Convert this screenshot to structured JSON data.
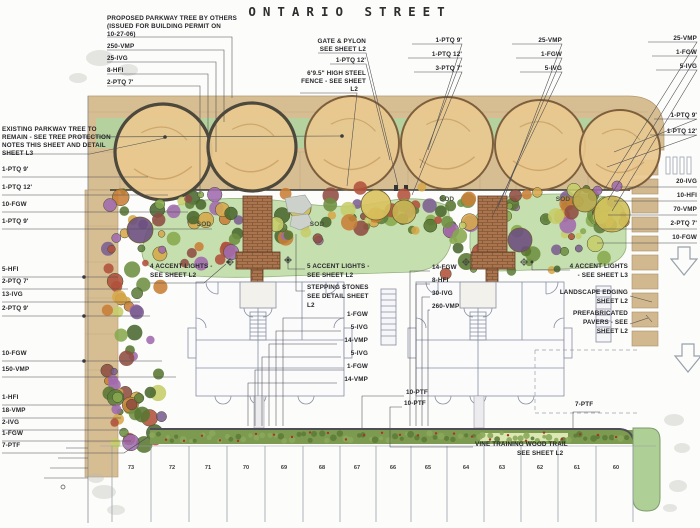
{
  "title": "ONTARIO STREET",
  "colors": {
    "sidewalk_tan": "#d7bd92",
    "parkway_lawn": "#b4d19e",
    "sod_lawn": "#c6dfae",
    "tree_canopy": "#e9c88f",
    "brick_walk": "#a9744e",
    "hedge_green": "#79994e",
    "building_line": "#868ea0",
    "leader_line": "#4b4b50"
  },
  "annotations": [
    {
      "t": "PROPOSED PARKWAY TREE BY OTHERS",
      "x": 107,
      "y": 15,
      "a": "L"
    },
    {
      "t": "(ISSUED FOR BUILDING PERMIT ON",
      "x": 107,
      "y": 23,
      "a": "L"
    },
    {
      "t": "10-27-06)",
      "x": 107,
      "y": 31,
      "a": "L"
    },
    {
      "t": "250-VMP",
      "x": 107,
      "y": 43,
      "a": "L"
    },
    {
      "t": "25-IVG",
      "x": 107,
      "y": 55,
      "a": "L"
    },
    {
      "t": "8-HFI",
      "x": 107,
      "y": 67,
      "a": "L"
    },
    {
      "t": "2-PTQ 7'",
      "x": 107,
      "y": 79,
      "a": "L"
    },
    {
      "t": "GATE & PYLON",
      "x": 366,
      "y": 38,
      "a": "R"
    },
    {
      "t": "SEE SHEET L2",
      "x": 366,
      "y": 46,
      "a": "R"
    },
    {
      "t": "1-PTQ 12'",
      "x": 366,
      "y": 57,
      "a": "R"
    },
    {
      "t": "6'9.5\" HIGH STEEL",
      "x": 366,
      "y": 70,
      "a": "R"
    },
    {
      "t": "FENCE - SEE SHEET",
      "x": 366,
      "y": 78,
      "a": "R"
    },
    {
      "t": "L2",
      "x": 358,
      "y": 86,
      "a": "R"
    },
    {
      "t": "1-PTQ 9'",
      "x": 462,
      "y": 37,
      "a": "R"
    },
    {
      "t": "1-PTQ 12'",
      "x": 462,
      "y": 51,
      "a": "R"
    },
    {
      "t": "3-PTQ 7'",
      "x": 462,
      "y": 65,
      "a": "R"
    },
    {
      "t": "25-VMP",
      "x": 562,
      "y": 37,
      "a": "R"
    },
    {
      "t": "1-FGW",
      "x": 562,
      "y": 51,
      "a": "R"
    },
    {
      "t": "5-IVG",
      "x": 562,
      "y": 65,
      "a": "R"
    },
    {
      "t": "25-VMP",
      "x": 697,
      "y": 35,
      "a": "R"
    },
    {
      "t": "1-FGW",
      "x": 697,
      "y": 49,
      "a": "R"
    },
    {
      "t": "5-IVG",
      "x": 697,
      "y": 63,
      "a": "R"
    },
    {
      "t": "1-PTQ 9'",
      "x": 697,
      "y": 112,
      "a": "R"
    },
    {
      "t": "1-PTQ 12'",
      "x": 697,
      "y": 128,
      "a": "R"
    },
    {
      "t": "20-IVG",
      "x": 697,
      "y": 178,
      "a": "R"
    },
    {
      "t": "10-HFI",
      "x": 697,
      "y": 192,
      "a": "R"
    },
    {
      "t": "70-VMP",
      "x": 697,
      "y": 206,
      "a": "R"
    },
    {
      "t": "2-PTQ 7'",
      "x": 697,
      "y": 220,
      "a": "R"
    },
    {
      "t": "10-FGW",
      "x": 697,
      "y": 234,
      "a": "R"
    },
    {
      "t": "EXISTING PARKWAY TREE TO",
      "x": 2,
      "y": 126,
      "a": "L"
    },
    {
      "t": "REMAIN - SEE TREE PROTECTION",
      "x": 2,
      "y": 134,
      "a": "L"
    },
    {
      "t": "NOTES THIS SHEET AND DETAIL",
      "x": 2,
      "y": 142,
      "a": "L"
    },
    {
      "t": "SHEET L3",
      "x": 2,
      "y": 150,
      "a": "L"
    },
    {
      "t": "1-PTQ 9'",
      "x": 2,
      "y": 166,
      "a": "L"
    },
    {
      "t": "1-PTQ 12'",
      "x": 2,
      "y": 184,
      "a": "L"
    },
    {
      "t": "10-FGW",
      "x": 2,
      "y": 201,
      "a": "L"
    },
    {
      "t": "1-PTQ 9'",
      "x": 2,
      "y": 218,
      "a": "L"
    },
    {
      "t": "5-HFI",
      "x": 2,
      "y": 266,
      "a": "L"
    },
    {
      "t": "2-PTQ 7'",
      "x": 2,
      "y": 278,
      "a": "L"
    },
    {
      "t": "13-IVG",
      "x": 2,
      "y": 291,
      "a": "L"
    },
    {
      "t": "2-PTQ 9'",
      "x": 2,
      "y": 305,
      "a": "L"
    },
    {
      "t": "10-FGW",
      "x": 2,
      "y": 350,
      "a": "L"
    },
    {
      "t": "150-VMP",
      "x": 2,
      "y": 366,
      "a": "L"
    },
    {
      "t": "1-HFI",
      "x": 2,
      "y": 394,
      "a": "L"
    },
    {
      "t": "18-VMP",
      "x": 2,
      "y": 407,
      "a": "L"
    },
    {
      "t": "2-IVG",
      "x": 2,
      "y": 419,
      "a": "L"
    },
    {
      "t": "1-FGW",
      "x": 2,
      "y": 430,
      "a": "L"
    },
    {
      "t": "7-PTF",
      "x": 2,
      "y": 442,
      "a": "L"
    },
    {
      "t": "4 ACCENT LIGHTS -",
      "x": 150,
      "y": 263,
      "a": "L"
    },
    {
      "t": "SEE SHEET L2",
      "x": 150,
      "y": 272,
      "a": "L"
    },
    {
      "t": "5 ACCENT LIGHTS -",
      "x": 307,
      "y": 263,
      "a": "L"
    },
    {
      "t": "SEE SHEET L2",
      "x": 307,
      "y": 272,
      "a": "L"
    },
    {
      "t": "STEPPING STONES",
      "x": 307,
      "y": 284,
      "a": "L"
    },
    {
      "t": "SEE DETAIL SHEET",
      "x": 307,
      "y": 293,
      "a": "L"
    },
    {
      "t": "L2",
      "x": 307,
      "y": 302,
      "a": "L"
    },
    {
      "t": "1-FGW",
      "x": 368,
      "y": 311,
      "a": "R"
    },
    {
      "t": "5-IVG",
      "x": 368,
      "y": 324,
      "a": "R"
    },
    {
      "t": "14-VMP",
      "x": 368,
      "y": 337,
      "a": "R"
    },
    {
      "t": "5-IVG",
      "x": 368,
      "y": 350,
      "a": "R"
    },
    {
      "t": "1-FGW",
      "x": 368,
      "y": 363,
      "a": "R"
    },
    {
      "t": "14-VMP",
      "x": 368,
      "y": 376,
      "a": "R"
    },
    {
      "t": "14-FGW",
      "x": 432,
      "y": 264,
      "a": "L"
    },
    {
      "t": "8-HFI",
      "x": 432,
      "y": 277,
      "a": "L"
    },
    {
      "t": "30-IVG",
      "x": 432,
      "y": 290,
      "a": "L"
    },
    {
      "t": "260-VMP",
      "x": 432,
      "y": 303,
      "a": "L"
    },
    {
      "t": "4 ACCENT LIGHTS",
      "x": 628,
      "y": 263,
      "a": "R"
    },
    {
      "t": "- SEE SHEET L3",
      "x": 628,
      "y": 272,
      "a": "R"
    },
    {
      "t": "LANDSCAPE EDGING",
      "x": 628,
      "y": 289,
      "a": "R"
    },
    {
      "t": "SHEET L2",
      "x": 628,
      "y": 298,
      "a": "R"
    },
    {
      "t": "PREFABRICATED",
      "x": 628,
      "y": 310,
      "a": "R"
    },
    {
      "t": "PAVERS - SEE",
      "x": 628,
      "y": 319,
      "a": "R"
    },
    {
      "t": "SHEET L2",
      "x": 628,
      "y": 328,
      "a": "R"
    },
    {
      "t": "10-PTF",
      "x": 406,
      "y": 389,
      "a": "L"
    },
    {
      "t": "10-PTF",
      "x": 404,
      "y": 400,
      "a": "L"
    },
    {
      "t": "7-PTF",
      "x": 575,
      "y": 401,
      "a": "L"
    },
    {
      "t": "VINE TRAINING WOOD TRAIL",
      "x": 475,
      "y": 441,
      "a": "L"
    },
    {
      "t": "SEE SHEET L2",
      "x": 517,
      "y": 450,
      "a": "L"
    },
    {
      "t": "SOD",
      "x": 204,
      "y": 221,
      "a": "C"
    },
    {
      "t": "SOD",
      "x": 317,
      "y": 221,
      "a": "C"
    },
    {
      "t": "SOD",
      "x": 447,
      "y": 196,
      "a": "C"
    },
    {
      "t": "SOD",
      "x": 563,
      "y": 196,
      "a": "C"
    }
  ],
  "parking": {
    "y": 465,
    "stalls": [
      {
        "n": "73",
        "x": 131
      },
      {
        "n": "72",
        "x": 172
      },
      {
        "n": "71",
        "x": 208
      },
      {
        "n": "70",
        "x": 246
      },
      {
        "n": "69",
        "x": 284
      },
      {
        "n": "68",
        "x": 322
      },
      {
        "n": "67",
        "x": 357
      },
      {
        "n": "66",
        "x": 393
      },
      {
        "n": "65",
        "x": 428
      },
      {
        "n": "64",
        "x": 466
      },
      {
        "n": "63",
        "x": 502
      },
      {
        "n": "62",
        "x": 540
      },
      {
        "n": "61",
        "x": 577
      },
      {
        "n": "60",
        "x": 616
      }
    ]
  }
}
